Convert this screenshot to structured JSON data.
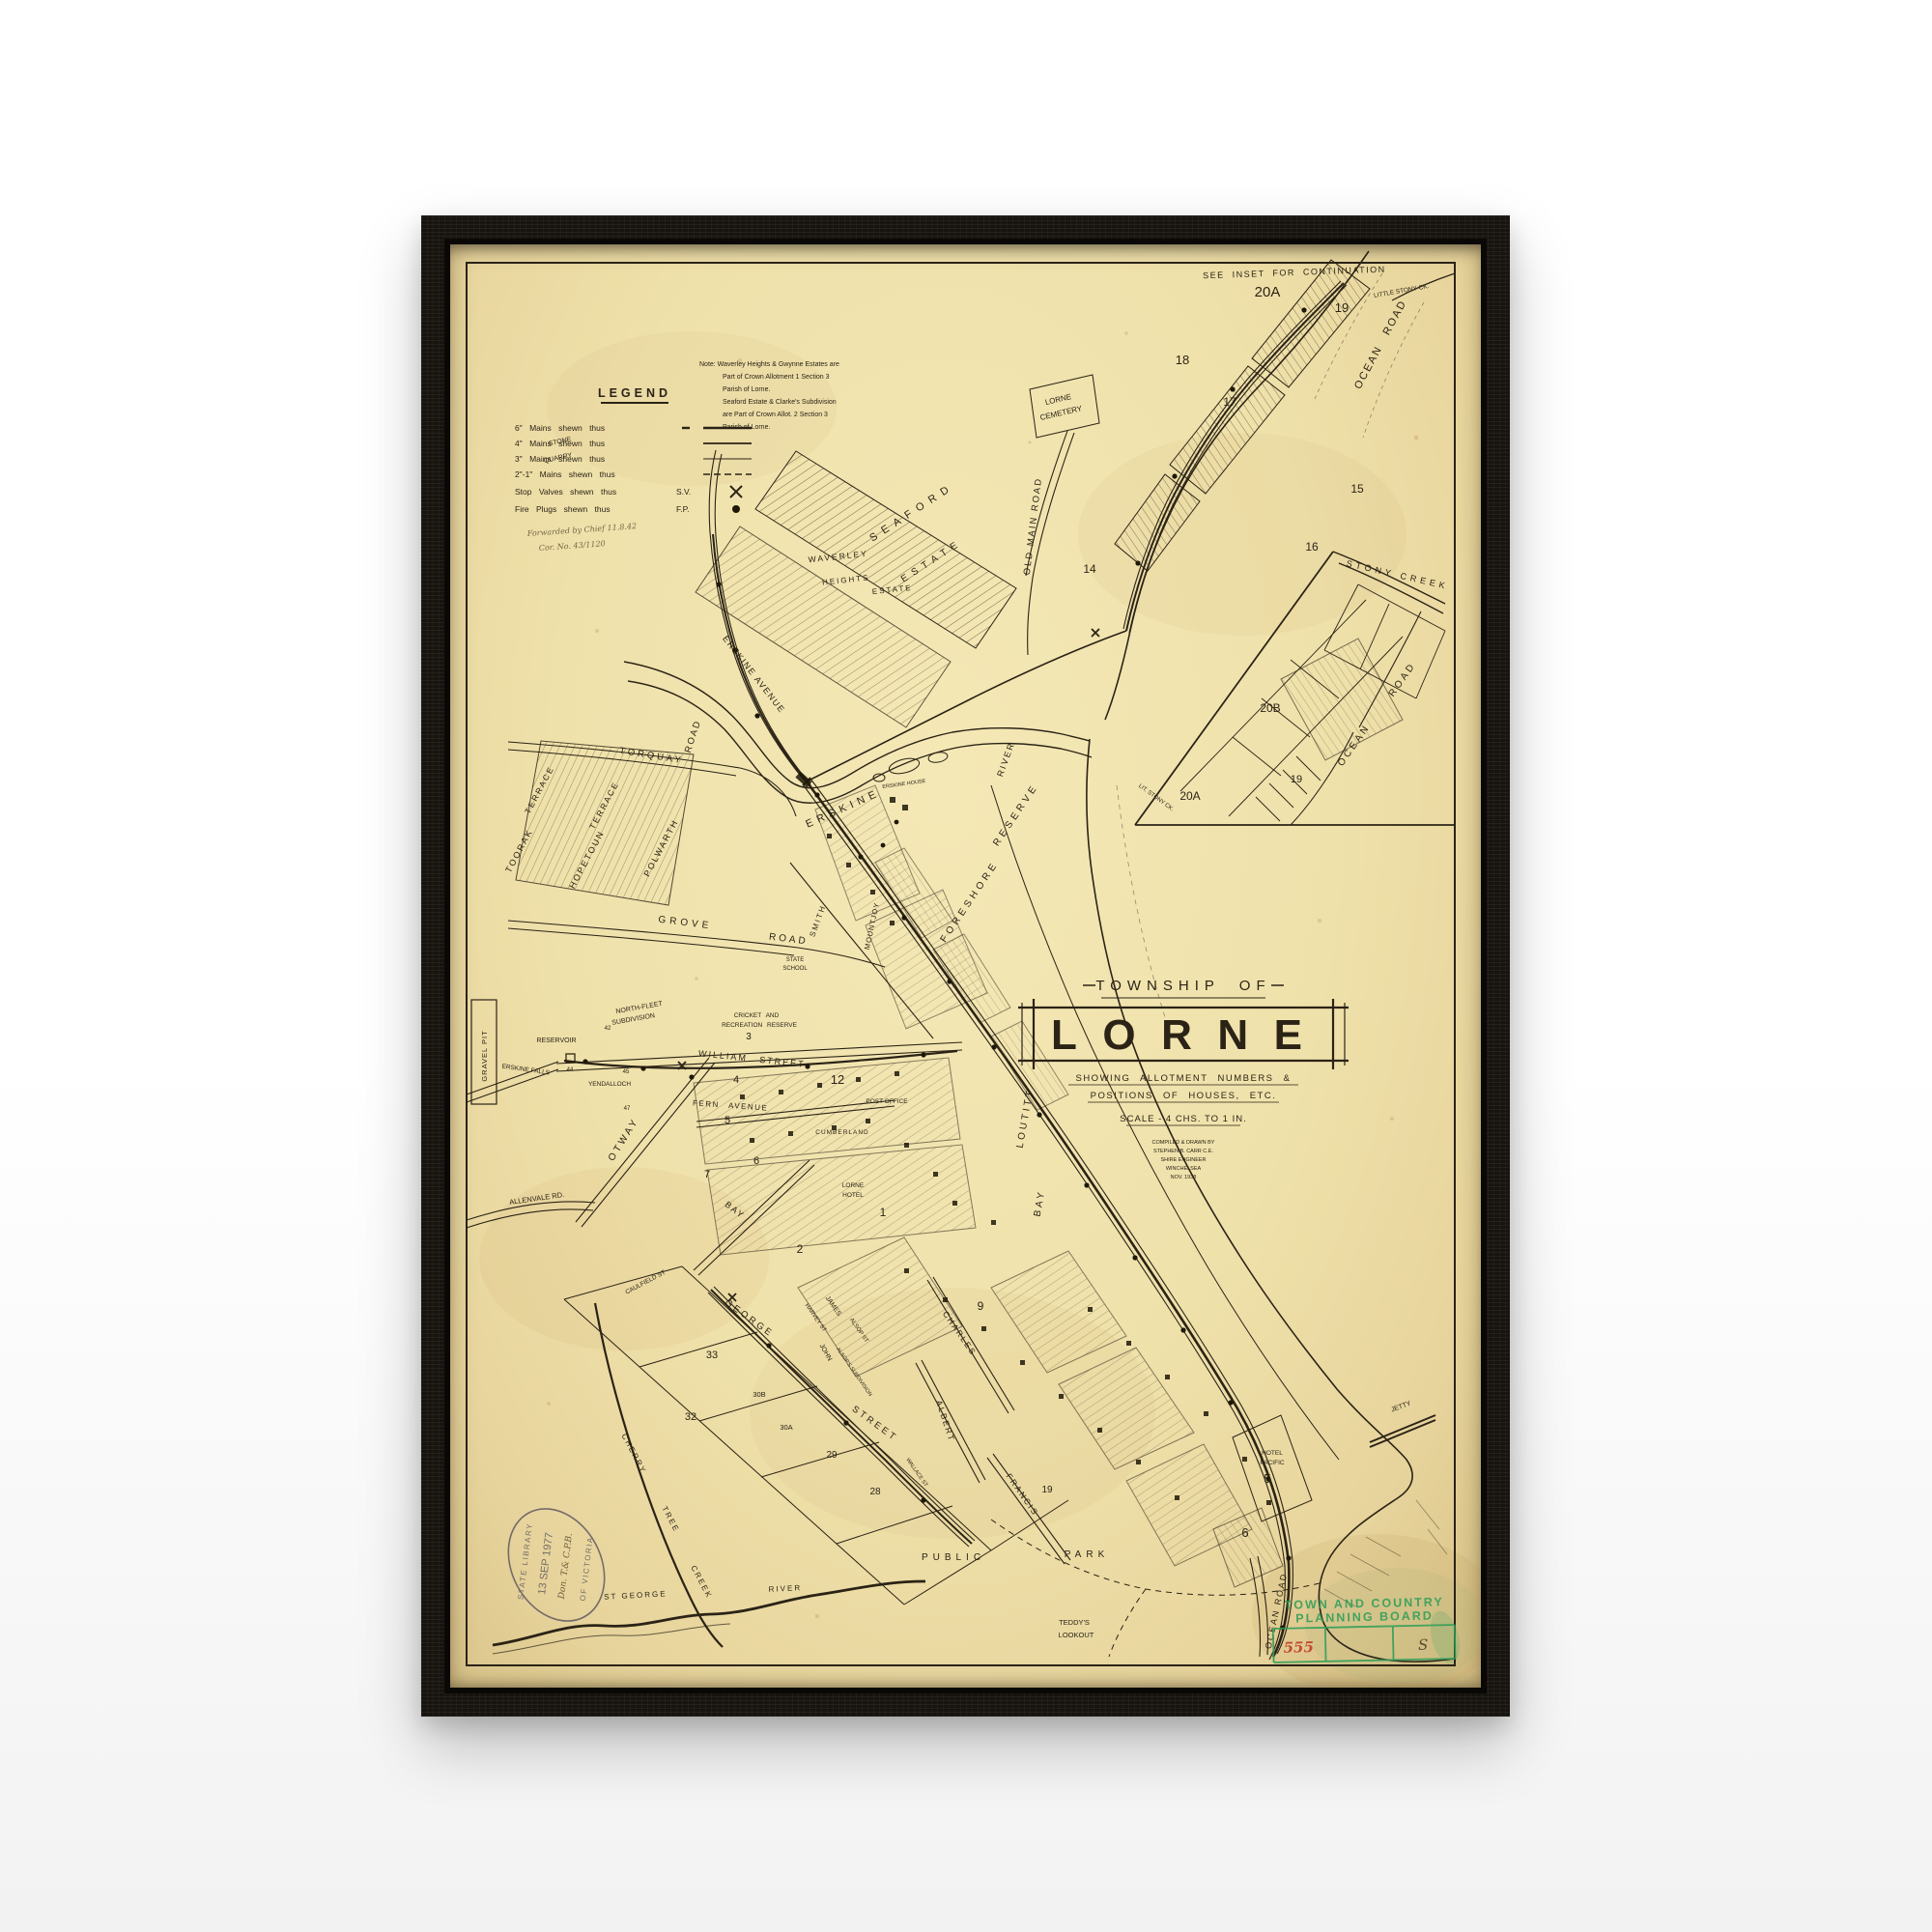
{
  "artwork": {
    "background_color": "#ffffff",
    "frame_color": "#17130f",
    "paper_color": "#efe1aa",
    "ink_color": "#2b2316"
  },
  "map": {
    "title_block": {
      "township": "TOWNSHIP OF",
      "name": "LORNE",
      "subtitle1": "SHOWING ALLOTMENT NUMBERS &",
      "subtitle2": "POSITIONS OF HOUSES, ETC.",
      "scale": "SCALE - 4 CHS. TO 1 IN.",
      "credits": [
        "COMPILED & DRAWN BY",
        "STEPHEN B. CARR C.E.",
        "SHIRE ENGINEER",
        "WINCHELSEA",
        "NOV. 1938"
      ]
    },
    "legend": {
      "heading": "LEGEND",
      "rows": [
        {
          "label": "6\" Mains shewn thus",
          "abbr": ""
        },
        {
          "label": "4\" Mains shewn thus",
          "abbr": ""
        },
        {
          "label": "3\" Mains shewn thus",
          "abbr": ""
        },
        {
          "label": "2\"-1\" Mains shewn thus",
          "abbr": ""
        },
        {
          "label": "Stop Valves shewn thus",
          "abbr": "S.V."
        },
        {
          "label": "Fire Plugs shewn thus",
          "abbr": "F.P."
        }
      ]
    },
    "handwriting": {
      "line1": "Forwarded by Chief 11.8.42",
      "line2": "Cor. No. 43/1120"
    },
    "note": {
      "lines": [
        "Note: Waverley Heights & Gwynne Estates are",
        "Part of Crown Allotment 1 Section 3",
        "Parish of Lorne.",
        "Seaford Estate & Clarke's Subdivision",
        "are Part of Crown Allot. 2 Section 3",
        "Parish of Lorne."
      ]
    },
    "labels": {
      "see_inset": "SEE INSET FOR CONTINUATION",
      "n20a_top": "20A",
      "n19_top": "19",
      "n18": "18",
      "n17": "17",
      "n16": "16",
      "n15": "15",
      "n14": "14",
      "little_stony": "LITTLE STONY CK.",
      "ocean_road_top": "OCEAN ROAD",
      "cemetery_1": "LORNE",
      "cemetery_2": "CEMETERY",
      "seaford": "SEAFORD",
      "seaford_estate": "ESTATE",
      "waverley": "WAVERLEY",
      "heights": "HEIGHTS",
      "waverley_estate": "ESTATE",
      "old_main_road": "OLD MAIN ROAD",
      "stone_quarry_1": "STONE",
      "stone_quarry_2": "QUARRY",
      "erskine_avenue": "ERSKINE AVENUE",
      "erskine": "ERSKINE",
      "river": "RIVER",
      "erskine_house": "ERSKINE HOUSE",
      "foreshore": "FORESHORE",
      "reserve": "RESERVE",
      "loutitt": "LOUTITT",
      "bay": "BAY",
      "inset_stony_creek": "STONY CREEK",
      "inset_ocean": "OCEAN",
      "inset_road": "ROAD",
      "inset_20b": "20B",
      "inset_20a": "20A",
      "inset_19": "19",
      "lit_stony": "LIT. STONY CK.",
      "toorak": "TOORAK",
      "toorak_terrace": "TERRACE",
      "hopetoun": "HOPETOUN",
      "hopetoun_terrace": "TERRACE",
      "torquay": "TORQUAY",
      "torquay_road": "ROAD",
      "polwarth": "POLWARTH",
      "grove": "GROVE",
      "grove_road": "ROAD",
      "state_school_1": "STATE",
      "state_school_2": "SCHOOL",
      "north_fleet": "NORTH-FLEET",
      "north_fleet_sub": "SUBDIVISION",
      "gravel_pit": "GRAVEL PIT",
      "reservoir": "RESERVOIR",
      "erskine_falls": "ERSKINE FALLS",
      "yendalloch": "YENDALLOCH",
      "otway": "OTWAY",
      "allenvale": "ALLENVALE RD.",
      "cricket_1": "CRICKET AND",
      "cricket_2": "RECREATION RESERVE",
      "n3": "3",
      "william_street": "WILLIAM STREET",
      "fern_avenue": "FERN AVENUE",
      "smith": "SMITH",
      "mountjoy": "MOUNTJOY",
      "post_office": "POST OFFICE",
      "n12": "12",
      "cumberland": "CUMBERLAND",
      "lorne_hotel_1": "LORNE",
      "lorne_hotel_2": "HOTEL",
      "bay_street": "BAY",
      "n1": "1",
      "n2": "2",
      "n4": "4",
      "n5": "5",
      "n6": "6",
      "n7": "7",
      "n9": "9",
      "george": "GEORGE",
      "george_street": "STREET",
      "albert": "ALBERT",
      "charles": "CHARLES",
      "francis": "FRANCIS",
      "john": "JOHN",
      "james": "JAMES",
      "harvey": "HARVEY ST",
      "alsop": "ALSOP ST",
      "alsops_sub": "ALSOP'S SUBDIVISION",
      "caulfield": "CAULFIELD ST",
      "wallace": "WALLACE ST",
      "lot33": "33",
      "lot32": "32",
      "lot30a": "30A",
      "lot30b": "30B",
      "lot29": "29",
      "lot28": "28",
      "lot19": "19",
      "lot42": "42",
      "lot44": "44",
      "lot45": "45",
      "lot47": "47",
      "hotel_pacific_1": "HOTEL",
      "hotel_pacific_2": "PACIFIC",
      "n5_hotel": "5",
      "jetty": "JETTY",
      "n6_low": "6",
      "ocean_road_bottom": "OCEAN ROAD",
      "public": "PUBLIC",
      "park": "PARK",
      "teddys_1": "TEDDY'S",
      "teddys_2": "LOOKOUT",
      "st_george": "ST GEORGE",
      "st_george_river": "RIVER",
      "cherry": "CHERRY",
      "tree": "TREE",
      "creek": "CREEK"
    },
    "stamps": {
      "planning": {
        "line1": "TOWN AND COUNTRY",
        "line2": "PLANNING BOARD",
        "ref": "555",
        "letter": "S",
        "color": "#2f9e58",
        "ref_color": "#bf3a2b"
      },
      "library": {
        "top": "STATE LIBRARY",
        "bottom": "OF VICTORIA",
        "date": "13 SEP 1977",
        "note": "Don. T.& C.P.B.",
        "color": "#59525e"
      }
    }
  }
}
